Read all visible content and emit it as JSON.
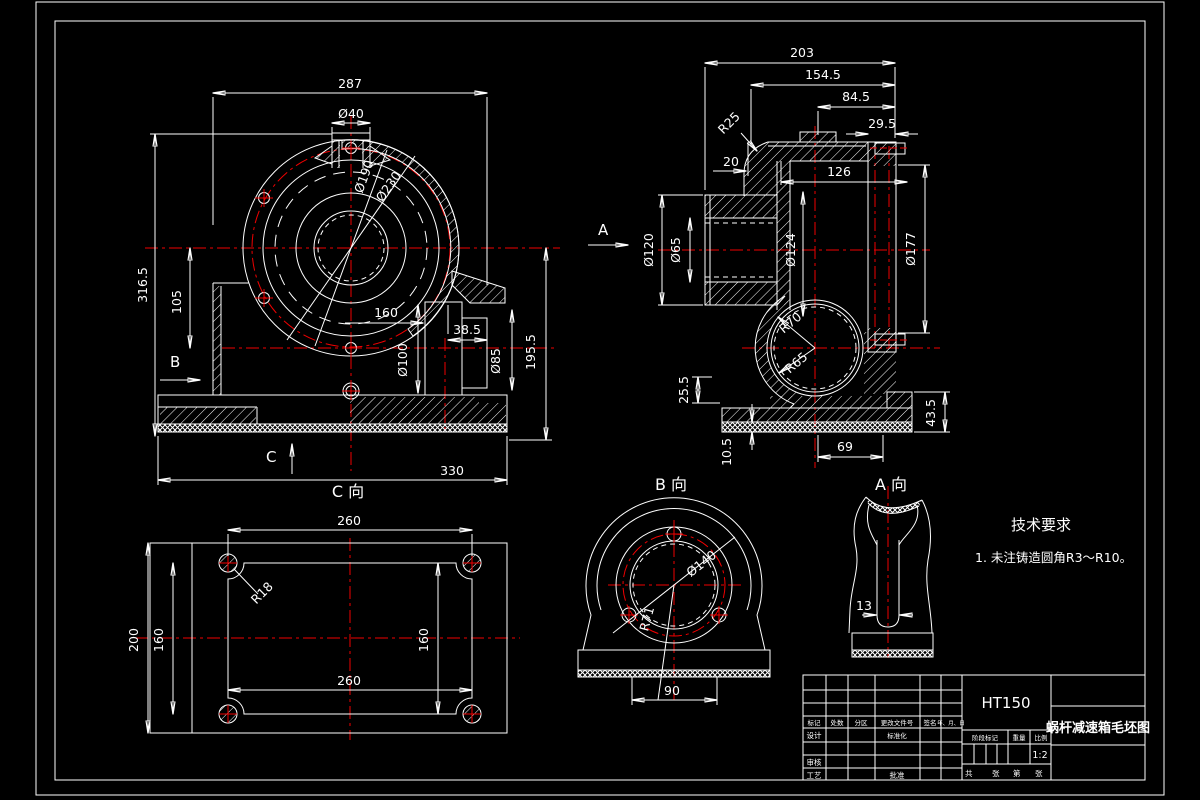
{
  "colors": {
    "background": "#000000",
    "line": "#ffffff",
    "centerline": "#f00000"
  },
  "front": {
    "dims": {
      "w287": "287",
      "d40": "Ø40",
      "d190": "Ø190",
      "d230": "Ø230",
      "h3165": "316.5",
      "h105": "105",
      "w160": "160",
      "w385": "38.5",
      "d100": "Ø100",
      "d85": "Ø85",
      "h1955": "195.5",
      "w330": "330"
    },
    "labels": {
      "b": "B",
      "c": "C"
    }
  },
  "side": {
    "dims": {
      "w203": "203",
      "w1545": "154.5",
      "w845": "84.5",
      "w295": "29.5",
      "r25": "R25",
      "t20": "20",
      "w126": "126",
      "d120": "Ø120",
      "d65": "Ø65",
      "d124": "Ø124",
      "d177": "Ø177",
      "r70": "R70",
      "r65": "R65",
      "h255": "25.5",
      "h105": "10.5",
      "w69": "69",
      "h435": "43.5"
    },
    "labels": {
      "a": "A"
    }
  },
  "c_view": {
    "caption": "C 向",
    "dims": {
      "w260_top": "260",
      "r18": "R18",
      "h200": "200",
      "h160_left": "160",
      "h160_right": "160",
      "w260_bottom": "260"
    }
  },
  "b_view": {
    "caption": "B 向",
    "dims": {
      "d140": "Ø140",
      "r71": "R71",
      "w90": "90"
    }
  },
  "a_view": {
    "caption": "A 向",
    "dims": {
      "t13": "13"
    }
  },
  "tech_requirements": {
    "title": "技术要求",
    "items": [
      "1. 未注铸造圆角R3～R10。"
    ]
  },
  "title_block": {
    "material": "HT150",
    "drawing_title": "蜗杆减速箱毛坯图",
    "scale_value": "1:2",
    "labels": {
      "mark": "标记",
      "count": "处数",
      "zone": "分区",
      "doc_no": "更改文件号",
      "signature": "签名",
      "date": "年、月、日",
      "design": "设计",
      "standardization": "标准化",
      "audit": "审核",
      "process": "工艺",
      "approve": "批准",
      "stage_mark": "阶段标记",
      "weight": "重量",
      "scale": "比例",
      "total": "共",
      "sheets": "张",
      "number": "第",
      "sheet": "张"
    }
  }
}
